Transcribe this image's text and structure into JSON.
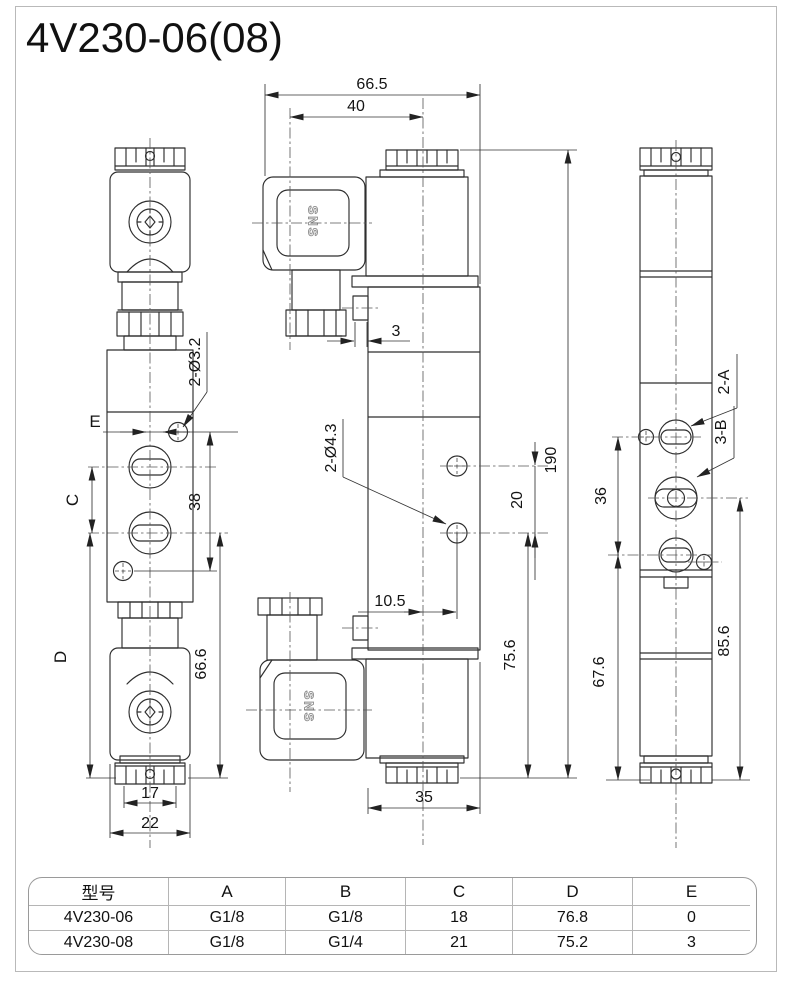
{
  "page": {
    "title": "4V230-06(08)"
  },
  "views": {
    "left": {
      "dims": {
        "hole_label": "2-Ø3.2",
        "e": "E",
        "c": "C",
        "d": "D",
        "v38": "38",
        "v66_6": "66.6",
        "v17": "17",
        "v22": "22"
      }
    },
    "middle": {
      "brand": "SNS",
      "dims": {
        "v66_5": "66.5",
        "v40": "40",
        "v3": "3",
        "hole_label": "2-Ø4.3",
        "v20": "20",
        "v190": "190",
        "v10_5": "10.5",
        "v75_6": "75.6",
        "v35": "35"
      }
    },
    "right": {
      "dims": {
        "port_a": "2-A",
        "port_b": "3-B",
        "v36": "36",
        "v67_6": "67.6",
        "v85_6": "85.6"
      }
    }
  },
  "table": {
    "headers": [
      "型号",
      "A",
      "B",
      "C",
      "D",
      "E"
    ],
    "rows": [
      [
        "4V230-06",
        "G1/8",
        "G1/8",
        "18",
        "76.8",
        "0"
      ],
      [
        "4V230-08",
        "G1/8",
        "G1/4",
        "21",
        "75.2",
        "3"
      ]
    ]
  },
  "colors": {
    "line": "#2e2e2e",
    "dimension": "#333333",
    "frame": "#b9b9b9",
    "table_border": "#9a9a9a"
  }
}
